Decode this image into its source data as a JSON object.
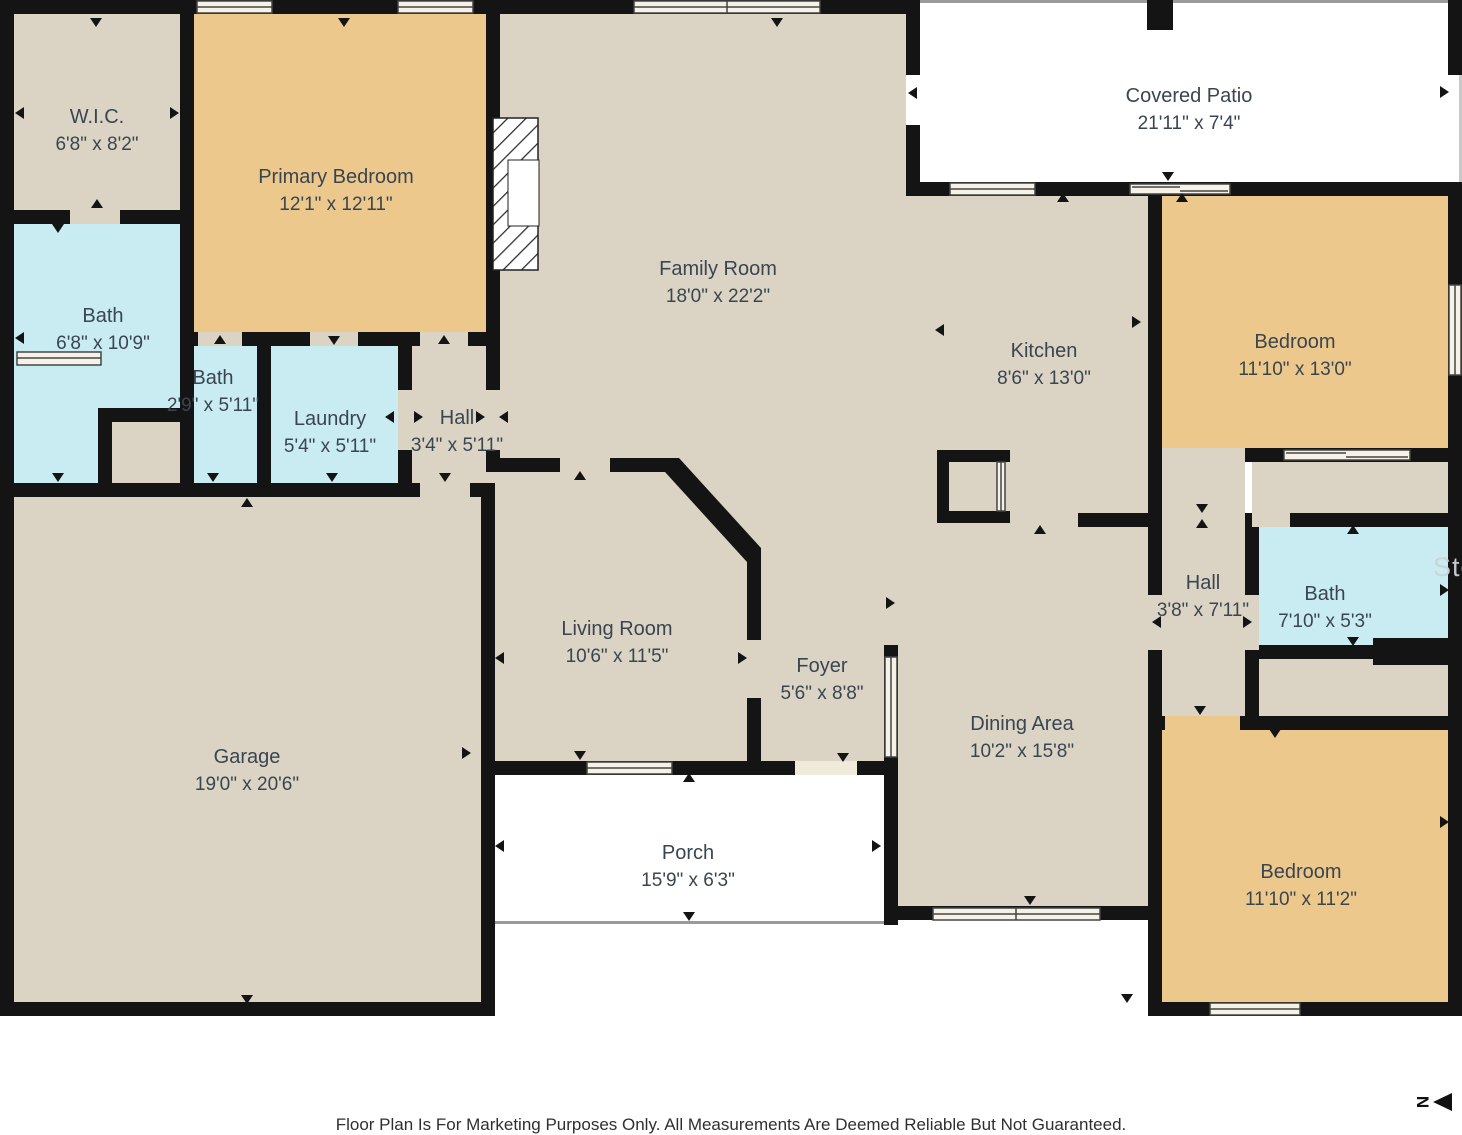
{
  "rooms": [
    {
      "id": "wic",
      "name": "W.I.C.",
      "dims": "6'8\" x 8'2\""
    },
    {
      "id": "primary-bedroom",
      "name": "Primary Bedroom",
      "dims": "12'1\" x 12'11\""
    },
    {
      "id": "family-room",
      "name": "Family Room",
      "dims": "18'0\" x 22'2\""
    },
    {
      "id": "covered-patio",
      "name": "Covered Patio",
      "dims": "21'11\" x 7'4\""
    },
    {
      "id": "kitchen",
      "name": "Kitchen",
      "dims": "8'6\" x 13'0\""
    },
    {
      "id": "bedroom-top-right",
      "name": "Bedroom",
      "dims": "11'10\" x 13'0\""
    },
    {
      "id": "bath-left",
      "name": "Bath",
      "dims": "6'8\" x 10'9\""
    },
    {
      "id": "bath-small",
      "name": "Bath",
      "dims": "2'9\" x 5'11\""
    },
    {
      "id": "laundry",
      "name": "Laundry",
      "dims": "5'4\" x 5'11\""
    },
    {
      "id": "hall-left",
      "name": "Hall",
      "dims": "3'4\" x 5'11\""
    },
    {
      "id": "hall-right",
      "name": "Hall",
      "dims": "3'8\" x 7'11\""
    },
    {
      "id": "bath-right",
      "name": "Bath",
      "dims": "7'10\" x 5'3\""
    },
    {
      "id": "garage",
      "name": "Garage",
      "dims": "19'0\" x 20'6\""
    },
    {
      "id": "living-room",
      "name": "Living Room",
      "dims": "10'6\" x 11'5\""
    },
    {
      "id": "foyer",
      "name": "Foyer",
      "dims": "5'6\" x 8'8\""
    },
    {
      "id": "dining-area",
      "name": "Dining Area",
      "dims": "10'2\" x 15'8\""
    },
    {
      "id": "porch",
      "name": "Porch",
      "dims": "15'9\" x 6'3\""
    },
    {
      "id": "bedroom-bottom-right",
      "name": "Bedroom",
      "dims": "11'10\" x 11'2\""
    }
  ],
  "footer": {
    "disclaimer": "Floor Plan Is For Marketing Purposes Only. All Measurements Are Deemed Reliable But Not Guaranteed."
  },
  "compass": {
    "letter": "N",
    "direction": "left"
  },
  "watermark": {
    "text": "Ste"
  },
  "colors": {
    "wall": "#141414",
    "floor": "#dbd4c5",
    "bedroom": "#ecc88d",
    "bath": "#c9ecf2",
    "outdoor": "#ffffff",
    "label": "#3a4550"
  }
}
